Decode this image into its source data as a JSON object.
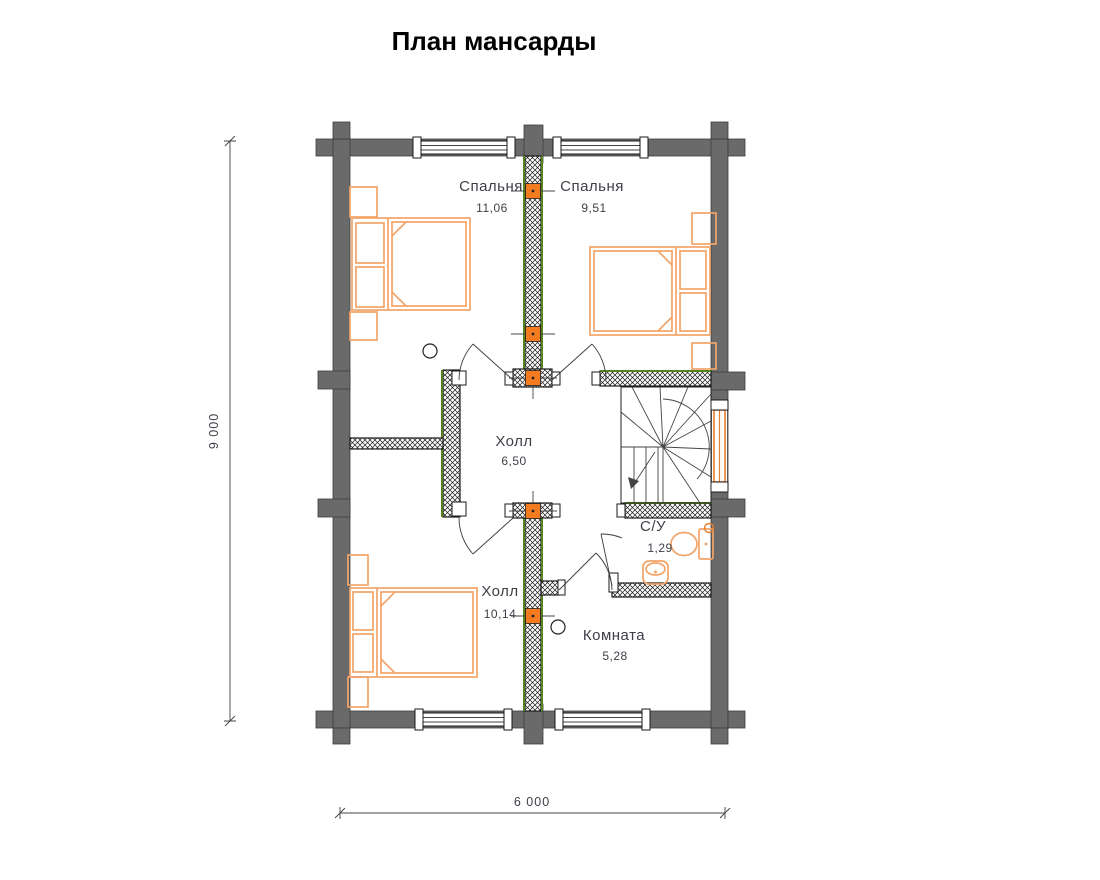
{
  "title": "План мансарды",
  "rooms": [
    {
      "name": "Спальня",
      "area": "11,06"
    },
    {
      "name": "Спальня",
      "area": "9,51"
    },
    {
      "name": "Холл",
      "area": "6,50"
    },
    {
      "name": "Холл",
      "area": "10,14"
    },
    {
      "name": "С/У",
      "area": "1,29"
    },
    {
      "name": "Комната",
      "area": "5,28"
    }
  ],
  "dimensions": {
    "vertical": "9 000",
    "horizontal": "6 000"
  },
  "colors": {
    "wall_gray": "#6a6a6a",
    "partition_green": "#55831e",
    "furniture_orange": "#f2a469",
    "marker_orange": "#f47b20",
    "label_color": "#3e3e48"
  }
}
